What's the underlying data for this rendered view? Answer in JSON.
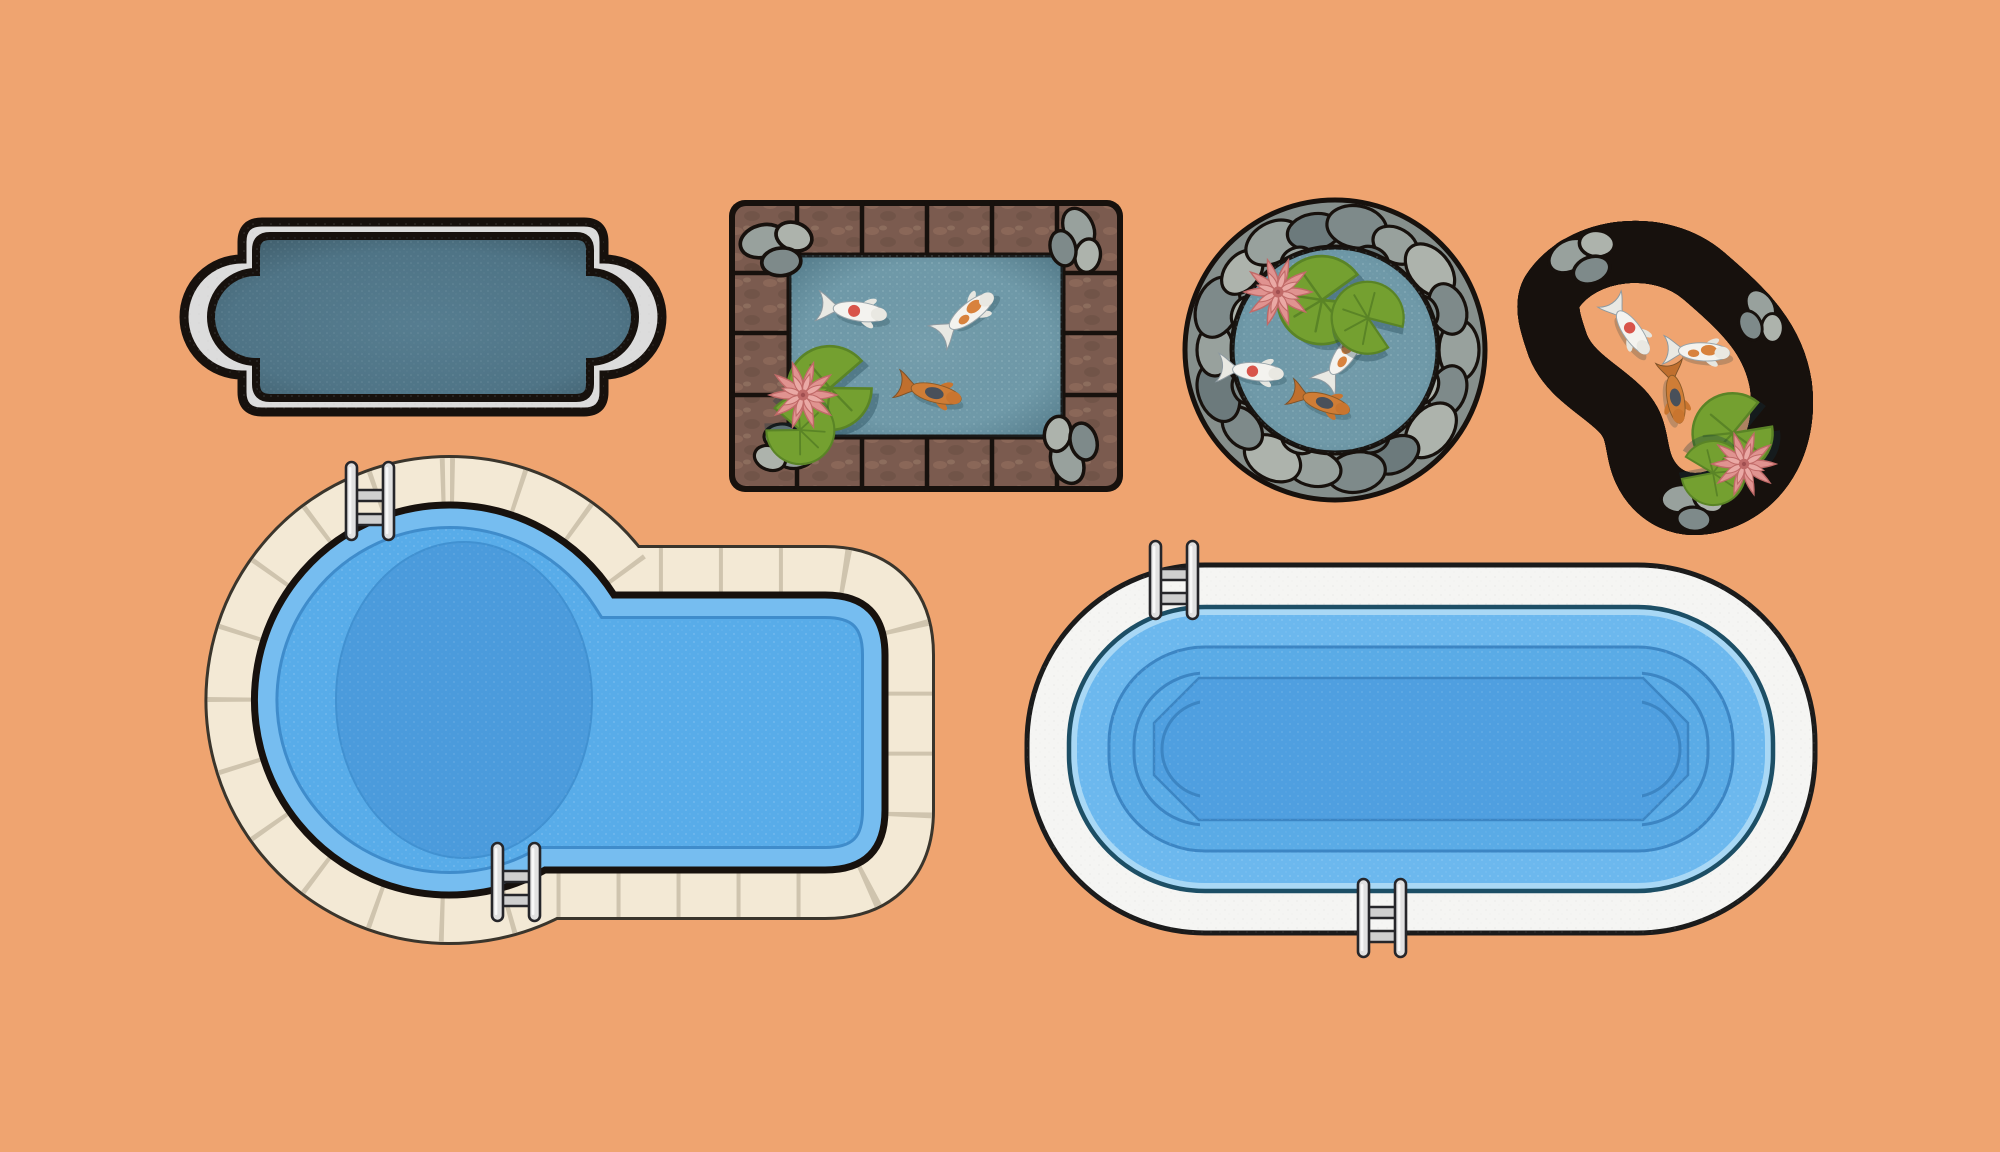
{
  "scene": {
    "title": "Swimming pools and koi ponds — top view illustration set",
    "background": "#efa470"
  },
  "palette": {
    "bg": "#efa470",
    "ink": "#17110d",
    "concrete": "#dcdcdc",
    "slate_water": "#4f7486",
    "slate_edge": "#415f6d",
    "pond_water": "#6f99a8",
    "pond_deep": "#2e505f",
    "brick": "#7b5b4f",
    "brick_light": "#93705f",
    "stone1": "#98a19d",
    "stone2": "#7e8a8a",
    "stone3": "#adb3ac",
    "stone4": "#6c7a7c",
    "lily": "#74a030",
    "lily_dark": "#5a8426",
    "lotus": "#e09390",
    "lotus_mid": "#eaa9a5",
    "lotus_deep": "#c06a68",
    "koi_white": "#f4f3ef",
    "koi_orange": "#d8823d",
    "koi_spot": "#d8544a",
    "koi_dark": "#49505a",
    "koi_body_orange": "#cf7d36",
    "deck_cream": "#f3e9d5",
    "deck_tile": "#cfc4ae",
    "deck_white": "#f5f5f3",
    "pool_water": "#58ace9",
    "pool_shelf": "#76bdf0",
    "pool_line": "#3f8ccb",
    "pool_deep": "#4b9bdc",
    "p6_ring": "#6cb8ee",
    "p6_basin": "#5aabe6",
    "p6_floor": "#4f9fe0",
    "p6_line": "#3c85c3",
    "p6_shelf": "#a9d8f5",
    "p6_edge": "#1d4f66",
    "chrome": "#e1e1e1",
    "chrome_mid": "#cfcfcf"
  },
  "items": [
    {
      "id": "roman-lap-pool",
      "kind": "lap pool with roman ends",
      "label": "Gray roman-end lap pool, dark slate water, concrete coping",
      "features": {
        "ladders": 0,
        "fish": 0,
        "lily_pads": 0,
        "lotus_flowers": 0
      }
    },
    {
      "id": "rect-koi-pond",
      "kind": "rectangular koi pond",
      "label": "Rectangular koi pond with brick border, corner rocks, three koi, lily pads and lotus",
      "features": {
        "fish": 3,
        "lily_pads": 2,
        "lotus_flowers": 1,
        "rock_clusters": 4
      }
    },
    {
      "id": "round-koi-pond",
      "kind": "circular koi pond",
      "label": "Round koi pond ringed with gray pebbles, three koi, lily pads and lotus",
      "features": {
        "fish": 3,
        "lily_pads": 2,
        "lotus_flowers": 1
      }
    },
    {
      "id": "kidney-koi-pond",
      "kind": "kidney-shaped koi pond",
      "label": "Bean-shaped koi pond with brick border, rocks, three koi, lily pads and lotus",
      "features": {
        "fish": 3,
        "lily_pads": 2,
        "lotus_flowers": 1,
        "rock_clusters": 3
      }
    },
    {
      "id": "kidney-swimming-pool",
      "kind": "kidney-shaped swimming pool",
      "label": "Kidney-shaped blue swimming pool with cream tiled deck, deep-end oval and two ladders",
      "features": {
        "ladders": 2
      }
    },
    {
      "id": "oval-swimming-pool",
      "kind": "oval swimming pool",
      "label": "Oval blue swimming pool with white deck, stepped basin and two ladders",
      "features": {
        "ladders": 2
      }
    }
  ]
}
